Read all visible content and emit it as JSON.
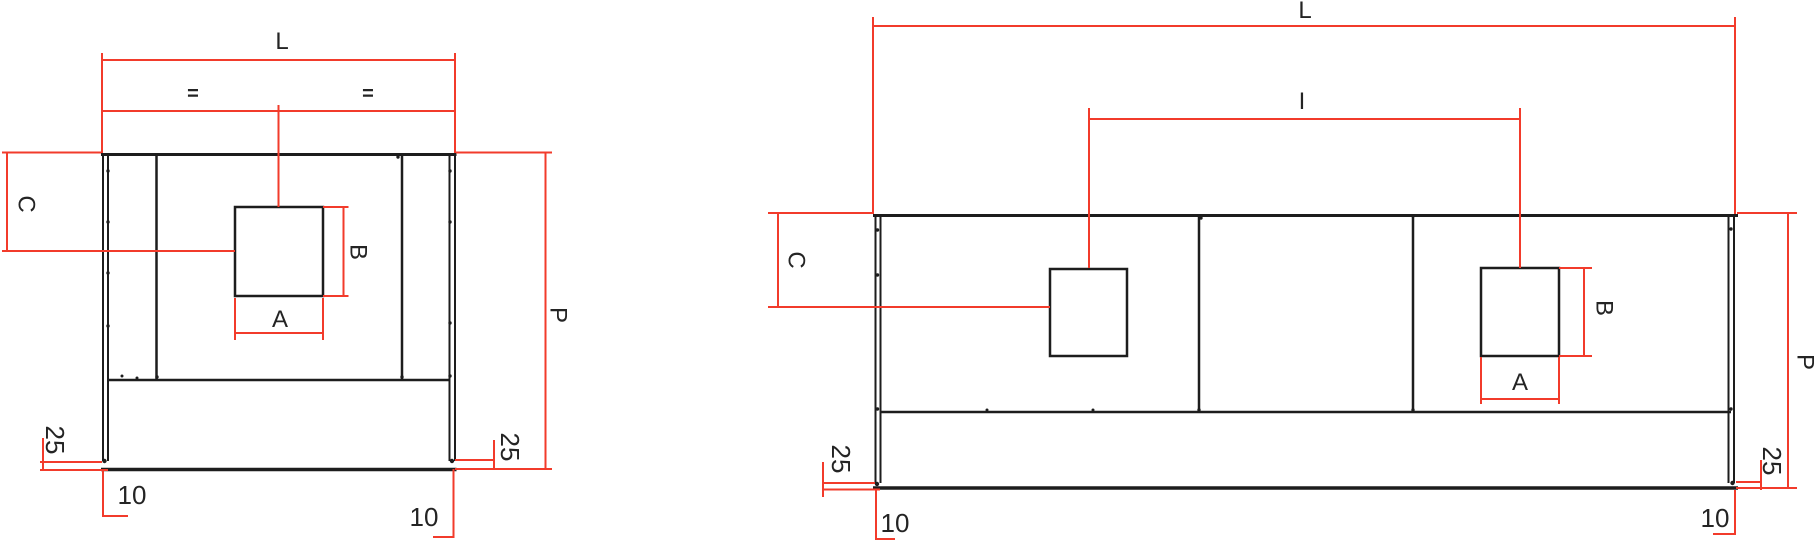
{
  "colors": {
    "line": "#1d1d1d",
    "dimension": "#f23b2b",
    "text": "#242424"
  },
  "left_view": {
    "dims": {
      "length": "L",
      "equal_left": "=",
      "equal_right": "=",
      "height_c": "C",
      "hole_width": "A",
      "hole_height": "B",
      "height_p": "P",
      "offset_25_left": "25",
      "offset_25_right": "25",
      "offset_10_left": "10",
      "offset_10_right": "10"
    }
  },
  "right_view": {
    "dims": {
      "length": "L",
      "centers": "I",
      "height_c": "C",
      "hole_width": "A",
      "hole_height": "B",
      "height_p": "P",
      "offset_25_left": "25",
      "offset_25_right": "25",
      "offset_10_left": "10",
      "offset_10_right": "10"
    }
  }
}
